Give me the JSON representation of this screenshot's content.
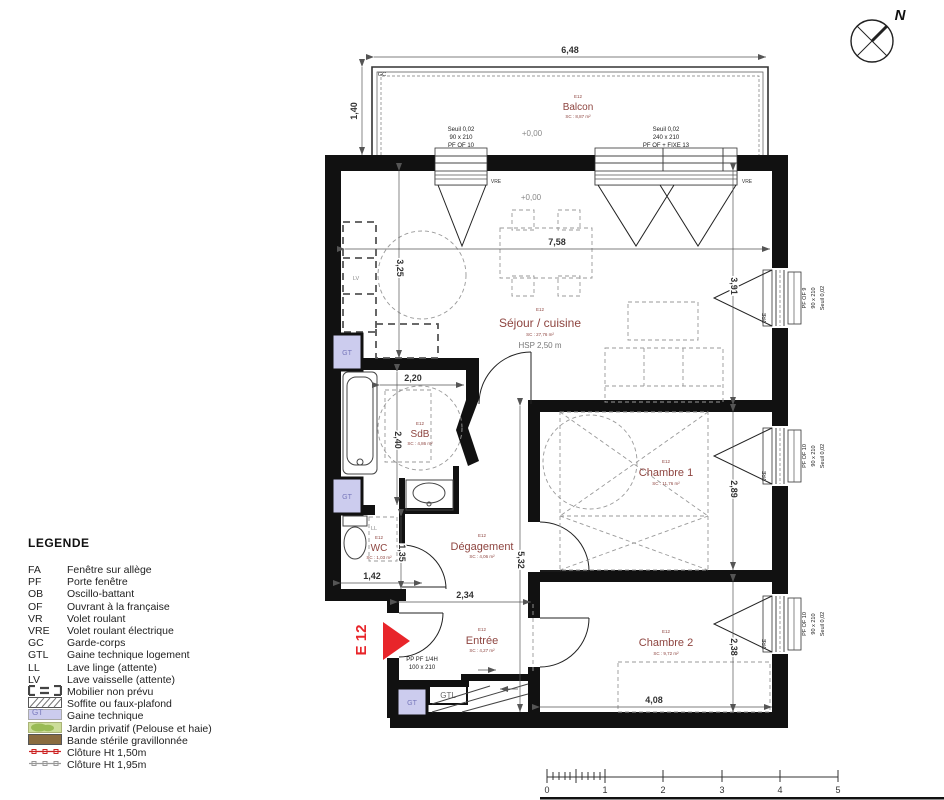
{
  "legend": {
    "title": "LEGENDE",
    "items": [
      {
        "abbr": "FA",
        "label": "Fenêtre sur allège"
      },
      {
        "abbr": "PF",
        "label": "Porte fenêtre"
      },
      {
        "abbr": "OB",
        "label": "Oscillo-battant"
      },
      {
        "abbr": "OF",
        "label": "Ouvrant à la française"
      },
      {
        "abbr": "VR",
        "label": "Volet roulant"
      },
      {
        "abbr": "VRE",
        "label": "Volet roulant électrique"
      },
      {
        "abbr": "GC",
        "label": "Garde-corps"
      },
      {
        "abbr": "GTL",
        "label": "Gaine technique logement"
      },
      {
        "abbr": "LL",
        "label": "Lave linge (attente)"
      },
      {
        "abbr": "LV",
        "label": "Lave vaisselle (attente)"
      },
      {
        "abbr": "",
        "label": "Mobilier non prévu"
      },
      {
        "abbr": "",
        "label": "Soffite ou faux-plafond"
      },
      {
        "abbr": "GT",
        "label": "Gaine technique"
      },
      {
        "abbr": "",
        "label": "Jardin privatif (Pelouse et haie)"
      },
      {
        "abbr": "",
        "label": "Bande stérile gravillonnée"
      },
      {
        "abbr": "",
        "label": "Clôture  Ht 1,50m"
      },
      {
        "abbr": "",
        "label": "Clôture  Ht 1,95m"
      }
    ]
  },
  "rooms": {
    "balcon": {
      "code": "E12",
      "name": "Balcon",
      "area": "SC : 8,87 m²"
    },
    "sejour": {
      "code": "E12",
      "name": "Séjour / cuisine",
      "area": "SC : 27,76 m²",
      "hsp": "HSP 2,50 m"
    },
    "chambre1": {
      "code": "E12",
      "name": "Chambre 1",
      "area": "SC : 11,76 m²"
    },
    "chambre2": {
      "code": "E12",
      "name": "Chambre 2",
      "area": "SC : 9,72 m²"
    },
    "sdb": {
      "code": "E12",
      "name": "SdB",
      "area": "SC : 4,86 m²"
    },
    "wc": {
      "code": "E12",
      "name": "WC",
      "area": "SC : 1,03 m²"
    },
    "degagement": {
      "code": "E12",
      "name": "Dégagement",
      "area": "SC : 4,06 m²"
    },
    "entree": {
      "code": "E12",
      "name": "Entrée",
      "area": "SC : 4,27 m²"
    }
  },
  "dimensions": {
    "balcony_width": "6,48",
    "balcony_depth": "1,40",
    "sejour_width": "7,58",
    "kitchen_height": "3,25",
    "sejour_height": "3,91",
    "sdb_width": "2,20",
    "sdb_height": "2,40",
    "chambre1_height": "2,89",
    "wc_height": "1,35",
    "wc_width": "1,42",
    "entree_width": "2,34",
    "degagement_height": "5,32",
    "chambre2_height": "2,38",
    "chambre2_width": "4,08"
  },
  "levels": {
    "balcony": "+0,00",
    "sejour": "+0,00"
  },
  "openings": {
    "balcony_left": {
      "seuil": "Seuil 0,02",
      "size": "90 x 210",
      "type": "PF OF 10",
      "shutter": "VRE"
    },
    "balcony_right": {
      "seuil": "Seuil 0,02",
      "size": "240 x 210",
      "type": "PF OF + FIXE 13",
      "shutter": "VRE"
    },
    "right1": {
      "seuil": "Seuil 0,02",
      "size": "90 x 210",
      "type": "PF OF 9",
      "shutter": "VRE"
    },
    "right2": {
      "seuil": "Seuil 0,02",
      "size": "90 x 210",
      "type": "PF OF 10",
      "shutter": "VRE"
    },
    "right3": {
      "seuil": "Seuil 0,02",
      "size": "90 x 210",
      "type": "PF OF 10",
      "shutter": "VRE"
    },
    "entry": {
      "type": "PP PF 1/4H",
      "size": "100 x 210"
    }
  },
  "annotations": {
    "gc": "GC",
    "ll": "LL",
    "lv": "LV",
    "gt": "GT",
    "gtl": "GTL",
    "unit": "E 12",
    "north": "N"
  },
  "scale_bar": {
    "labels": [
      "0",
      "1",
      "2",
      "3",
      "4",
      "5"
    ]
  },
  "colors": {
    "wall": "#111111",
    "room_label": "#8e4540",
    "accent_red": "#e8252a",
    "gt_fill": "#ccccee",
    "gt_text": "#7777bb",
    "garden_light": "#ccdd99",
    "garden_dark": "#99bb55",
    "gravel_brown": "#8a6b3f",
    "fence_red": "#cc2222",
    "fence_grey": "#999999"
  }
}
